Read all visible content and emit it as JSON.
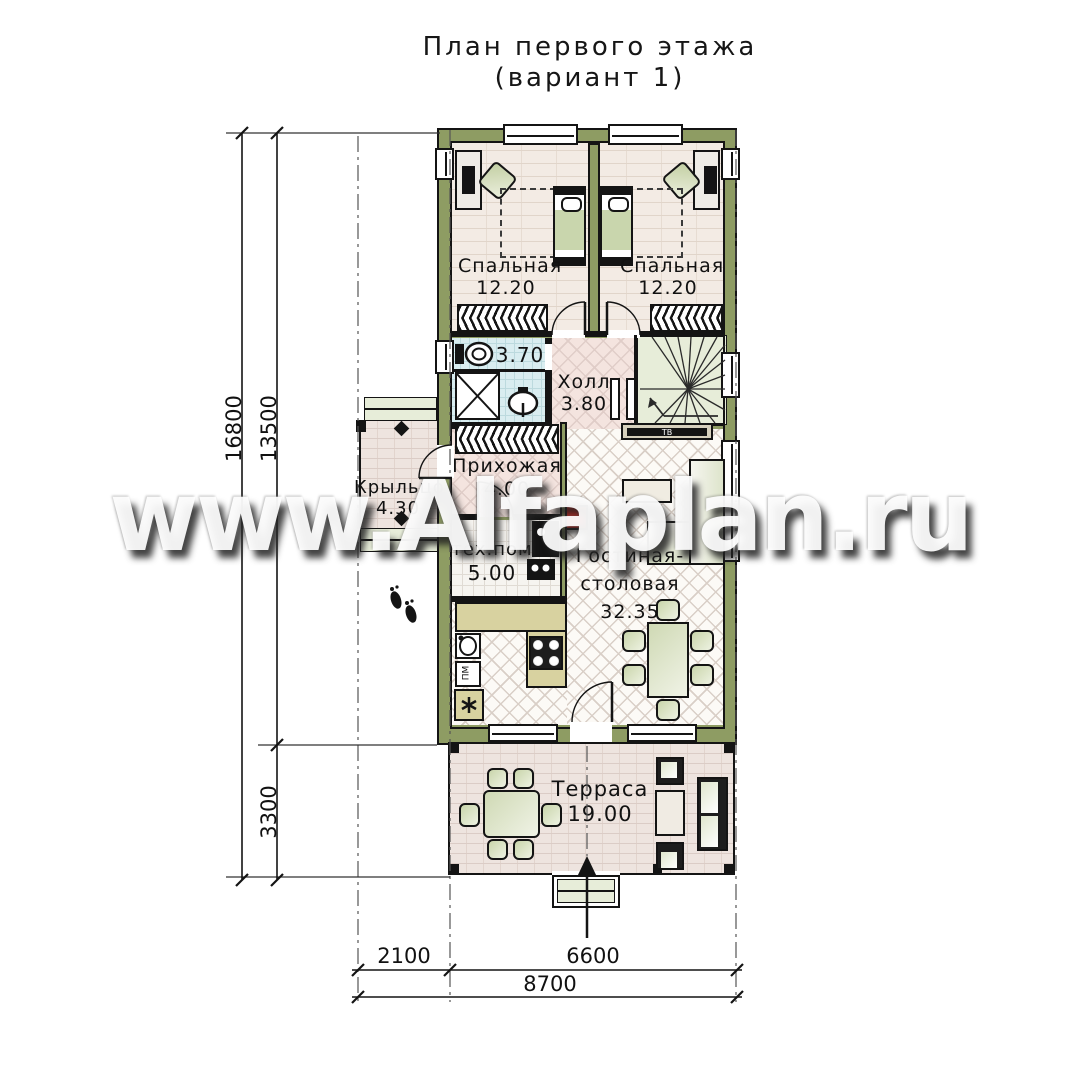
{
  "title": {
    "line1": "План первого этажа",
    "line2": "(вариант 1)"
  },
  "watermark": {
    "text": "www.Alfaplan.ru"
  },
  "rooms": {
    "bedroom1": {
      "name": "Спальная",
      "area": "12.20"
    },
    "bedroom2": {
      "name": "Спальная",
      "area": "12.20"
    },
    "bathroom": {
      "area": "3.70"
    },
    "hall": {
      "name": "Холл",
      "area": "3.80"
    },
    "entry": {
      "name": "Прихожая",
      "area": "4.00"
    },
    "porch": {
      "name": "Крыльцо",
      "area": "4.30"
    },
    "tech": {
      "name": "тех.пом",
      "area": "5.00"
    },
    "living": {
      "name_line1": "Гостиная-",
      "name_line2": "столовая",
      "area": "32.35"
    },
    "terrace": {
      "name": "Терраса",
      "area": "19.00"
    }
  },
  "dimensions": {
    "left_total": "16800",
    "left_house": "13500",
    "left_terrace": "3300",
    "bottom_porch": "2100",
    "bottom_house": "6600",
    "bottom_total": "8700"
  },
  "appliances": {
    "tv": "ТВ",
    "dishwasher": "ПМ"
  },
  "colors": {
    "wall": "#8e9c63",
    "accent_red": "#e3261c",
    "stair_tint": "#e7edd9"
  }
}
